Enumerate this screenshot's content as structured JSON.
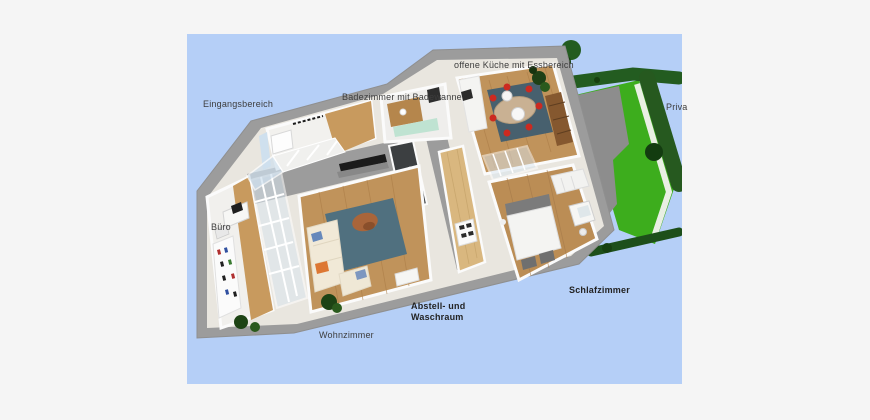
{
  "page": {
    "background_color": "#f5f5f5"
  },
  "render": {
    "sky_color": "#b5cff7",
    "palette": {
      "lawn_green": "#3dad1d",
      "hedge_green": "#235c20",
      "terrace_gray": "#8d8d8d",
      "wall_gray": "#9c9c9c",
      "wood_floor": "#c0935b",
      "rug_blue_gray": "#4e6b7a",
      "dining_chair_red": "#cc2a20",
      "dark_tile": "#3c3f41",
      "label_text": "#3d3d3d"
    },
    "labels": [
      {
        "id": "eingangsbereich",
        "text": "Eingangsbereich",
        "left": 16,
        "top": 65,
        "bold": false
      },
      {
        "id": "badezimmer",
        "text": "Badezimmer mit Badewanne",
        "left": 155,
        "top": 58,
        "bold": false
      },
      {
        "id": "offene-kueche",
        "text": "offene Küche mit Essbereich",
        "left": 267,
        "top": 26,
        "bold": false
      },
      {
        "id": "privatgarten",
        "text": "Priva",
        "left": 479,
        "top": 68,
        "bold": false
      },
      {
        "id": "buero",
        "text": "Büro",
        "left": 24,
        "top": 188,
        "bold": false
      },
      {
        "id": "wohnzimmer",
        "text": "Wohnzimmer",
        "left": 132,
        "top": 296,
        "bold": false
      },
      {
        "id": "abstell-waschraum",
        "text": "Abstell- und\nWaschraum",
        "left": 224,
        "top": 267,
        "bold": true
      },
      {
        "id": "schlafzimmer",
        "text": "Schlafzimmer",
        "left": 382,
        "top": 251,
        "bold": true
      }
    ]
  }
}
